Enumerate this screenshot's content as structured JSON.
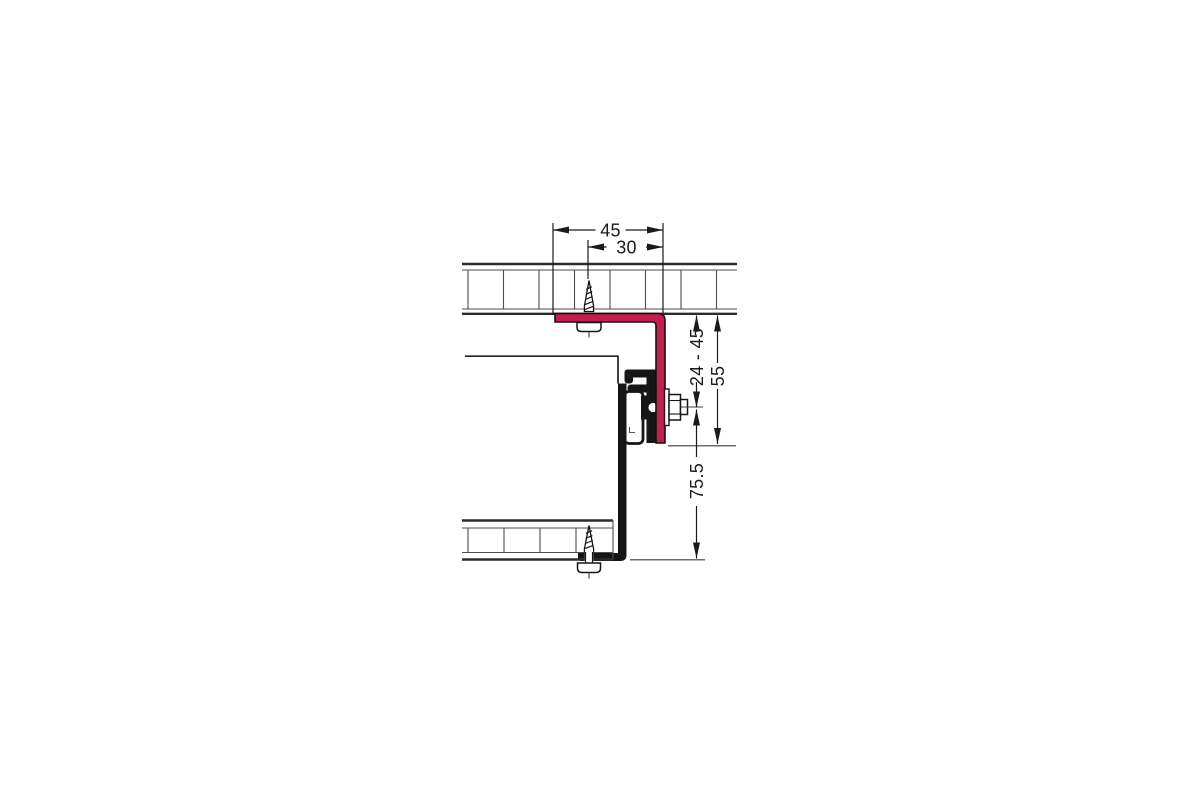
{
  "drawing": {
    "dimension_labels": {
      "bracket_width": "45",
      "screw_offset": "30",
      "adjustment_range": "24 - 45",
      "bracket_height": "55",
      "hanger_distance": "75.5"
    },
    "colors": {
      "bracket_red": "#c41e4c",
      "line_dark": "#1a1a1a"
    }
  }
}
